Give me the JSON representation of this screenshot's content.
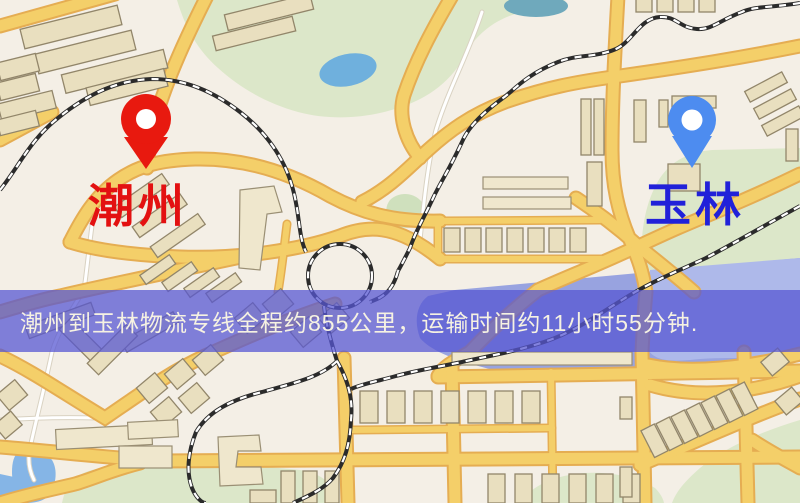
{
  "banner": {
    "text": "潮州到玉林物流专线全程约855公里，运输时间约11小时55分钟."
  },
  "route_info": {
    "origin": "潮州",
    "destination": "玉林",
    "distance_km": "855",
    "duration_hours": "11",
    "duration_minutes": "55"
  },
  "markers": {
    "origin": {
      "label": "潮州"
    },
    "destination": {
      "label": "玉林"
    }
  },
  "colors": {
    "bg": "#f4efe6",
    "park": "#dce7c9",
    "water": "#98a3e0",
    "lake": "#85b5e6",
    "road": "#f4cf69",
    "road_casing": "#e5ad52",
    "rail": "#2b2b2b",
    "building": "#e9dfbf",
    "pin_red": "#e8190f",
    "pin_blue": "#4d8cf0",
    "label_red": "#e31111",
    "label_blue": "#2121d9",
    "banner_bg": "rgba(86,86,210,0.74)",
    "banner_text": "#f6f2e2"
  }
}
